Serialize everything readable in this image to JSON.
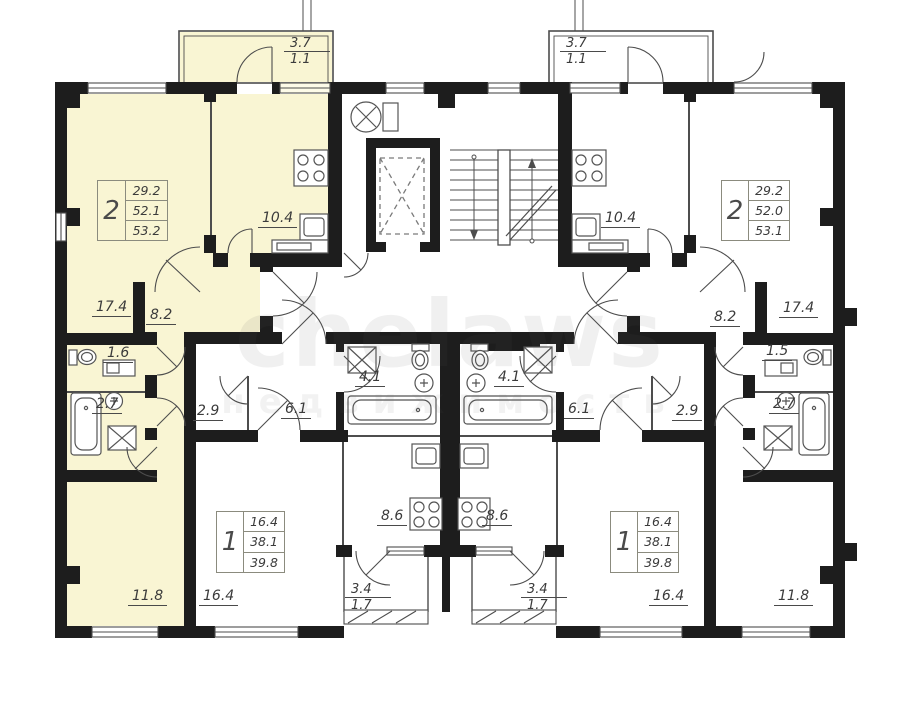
{
  "watermark": {
    "line1": "chelaws",
    "line2": "недвижимость"
  },
  "apartments": [
    {
      "id": "two-room-left",
      "rooms": "2",
      "areas": [
        "29.2",
        "52.1",
        "53.2"
      ]
    },
    {
      "id": "two-room-right",
      "rooms": "2",
      "areas": [
        "29.2",
        "52.0",
        "53.1"
      ]
    },
    {
      "id": "one-room-left",
      "rooms": "1",
      "areas": [
        "16.4",
        "38.1",
        "39.8"
      ]
    },
    {
      "id": "one-room-right",
      "rooms": "1",
      "areas": [
        "16.4",
        "38.1",
        "39.8"
      ]
    }
  ],
  "room_labels": [
    {
      "id": "living-left",
      "text": "17.4"
    },
    {
      "id": "hall-left",
      "text": "8.2"
    },
    {
      "id": "kitchen-left",
      "text": "10.4"
    },
    {
      "id": "wc-left",
      "text": "1.6"
    },
    {
      "id": "bath-left",
      "text": "2.7"
    },
    {
      "id": "room-11-left",
      "text": "11.8"
    },
    {
      "id": "room-16-left",
      "text": "16.4"
    },
    {
      "id": "storage-left",
      "text": "2.9"
    },
    {
      "id": "hall-1room-left",
      "text": "6.1"
    },
    {
      "id": "bathroom-center-left",
      "text": "4.1"
    },
    {
      "id": "bathroom-center-right",
      "text": "4.1"
    },
    {
      "id": "kitchen-1room-left",
      "text": "8.6"
    },
    {
      "id": "kitchen-1room-right",
      "text": "8.6"
    },
    {
      "id": "hall-1room-right",
      "text": "6.1"
    },
    {
      "id": "storage-right",
      "text": "2.9"
    },
    {
      "id": "wc-right",
      "text": "1.5"
    },
    {
      "id": "bath-right",
      "text": "2.7"
    },
    {
      "id": "hall-right",
      "text": "8.2"
    },
    {
      "id": "living-right",
      "text": "17.4"
    },
    {
      "id": "kitchen-right",
      "text": "10.4"
    },
    {
      "id": "room-16-right",
      "text": "16.4"
    },
    {
      "id": "room-11-right",
      "text": "11.8"
    }
  ],
  "balconies": [
    {
      "id": "balcony-top-left",
      "total": "3.7",
      "reduced": "1.1"
    },
    {
      "id": "balcony-top-right",
      "total": "3.7",
      "reduced": "1.1"
    },
    {
      "id": "balcony-bottom-left",
      "total": "3.4",
      "reduced": "1.7"
    },
    {
      "id": "balcony-bottom-right",
      "total": "3.4",
      "reduced": "1.7"
    }
  ],
  "colors": {
    "highlight": "#f9f5d3",
    "wall": "#1d1d1d",
    "partition": "#4d4d4d",
    "fixture": "#555555",
    "label": "#3b3b3b"
  }
}
